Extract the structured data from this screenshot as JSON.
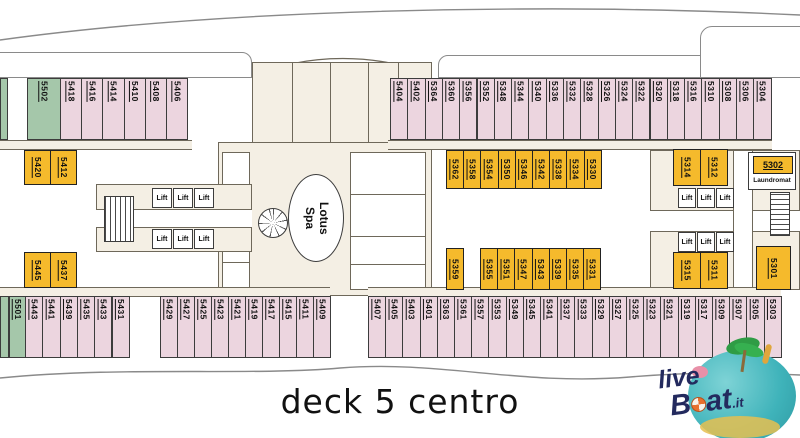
{
  "title": "deck 5 centro",
  "labels": {
    "lift": "Lift",
    "laundromat": "Laundromat",
    "spa": "Lotus\nSpa"
  },
  "watermark": {
    "live": "live",
    "boat_prefix": "B",
    "boat_suffix": "at",
    "domain": ".it"
  },
  "colors": {
    "cabin_pink": "#ecd5df",
    "cabin_green": "#a5c7aa",
    "cabin_yellow": "#f5ba2c",
    "wall_beige": "#f4efe4",
    "outline": "#3c3c3c",
    "watermark_navy": "#232a5e",
    "watermark_teal": "#3fb3ba"
  },
  "cabins": {
    "top_left_green": [
      "5502"
    ],
    "top_left_pink": [
      "5418",
      "5416",
      "5414",
      "5410",
      "5408",
      "5406"
    ],
    "top_right_pink": [
      "5404",
      "5402",
      "5364",
      "5360",
      "5356",
      "5352",
      "5348",
      "5344",
      "5340",
      "5336",
      "5332",
      "5328",
      "5326",
      "5324",
      "5322",
      "5320",
      "5318",
      "5316",
      "5310",
      "5308",
      "5306",
      "5304"
    ],
    "mid_left_upper_yellow": [
      "5420",
      "5412"
    ],
    "mid_left_lower_yellow": [
      "5445",
      "5437"
    ],
    "mid_right_upper_yellow": [
      "5362",
      "5358",
      "5354",
      "5350",
      "5346",
      "5342",
      "5338",
      "5334",
      "5330"
    ],
    "mid_right_lower_yellow_single": [
      "5359"
    ],
    "mid_right_lower_yellow": [
      "5355",
      "5351",
      "5347",
      "5343",
      "5339",
      "5335",
      "5331"
    ],
    "right_upper_yellow": [
      "5314",
      "5312"
    ],
    "right_lower_yellow": [
      "5315",
      "5311"
    ],
    "laundromat_cabin": [
      "5302"
    ],
    "right_stern_yellow": [
      "5301"
    ],
    "bottom_left_green": [
      "5501"
    ],
    "bottom_left_pink": [
      "5443",
      "5441",
      "5439",
      "5435",
      "5433",
      "5431"
    ],
    "bottom_mid_pink": [
      "5429",
      "5427",
      "5425",
      "5423",
      "5421",
      "5419",
      "5417",
      "5415",
      "5411",
      "5409"
    ],
    "bottom_right_pink": [
      "5407",
      "5405",
      "5403",
      "5401",
      "5363",
      "5361",
      "5357",
      "5353",
      "5349",
      "5345",
      "5341",
      "5337",
      "5333",
      "5329",
      "5327",
      "5325",
      "5323",
      "5321",
      "5319",
      "5317",
      "5309",
      "5307",
      "5305",
      "5303"
    ]
  },
  "lift_banks": [
    {
      "id": "left-upper",
      "count": 3
    },
    {
      "id": "left-lower",
      "count": 3
    },
    {
      "id": "right-upper",
      "count": 3
    },
    {
      "id": "right-lower",
      "count": 3
    }
  ]
}
